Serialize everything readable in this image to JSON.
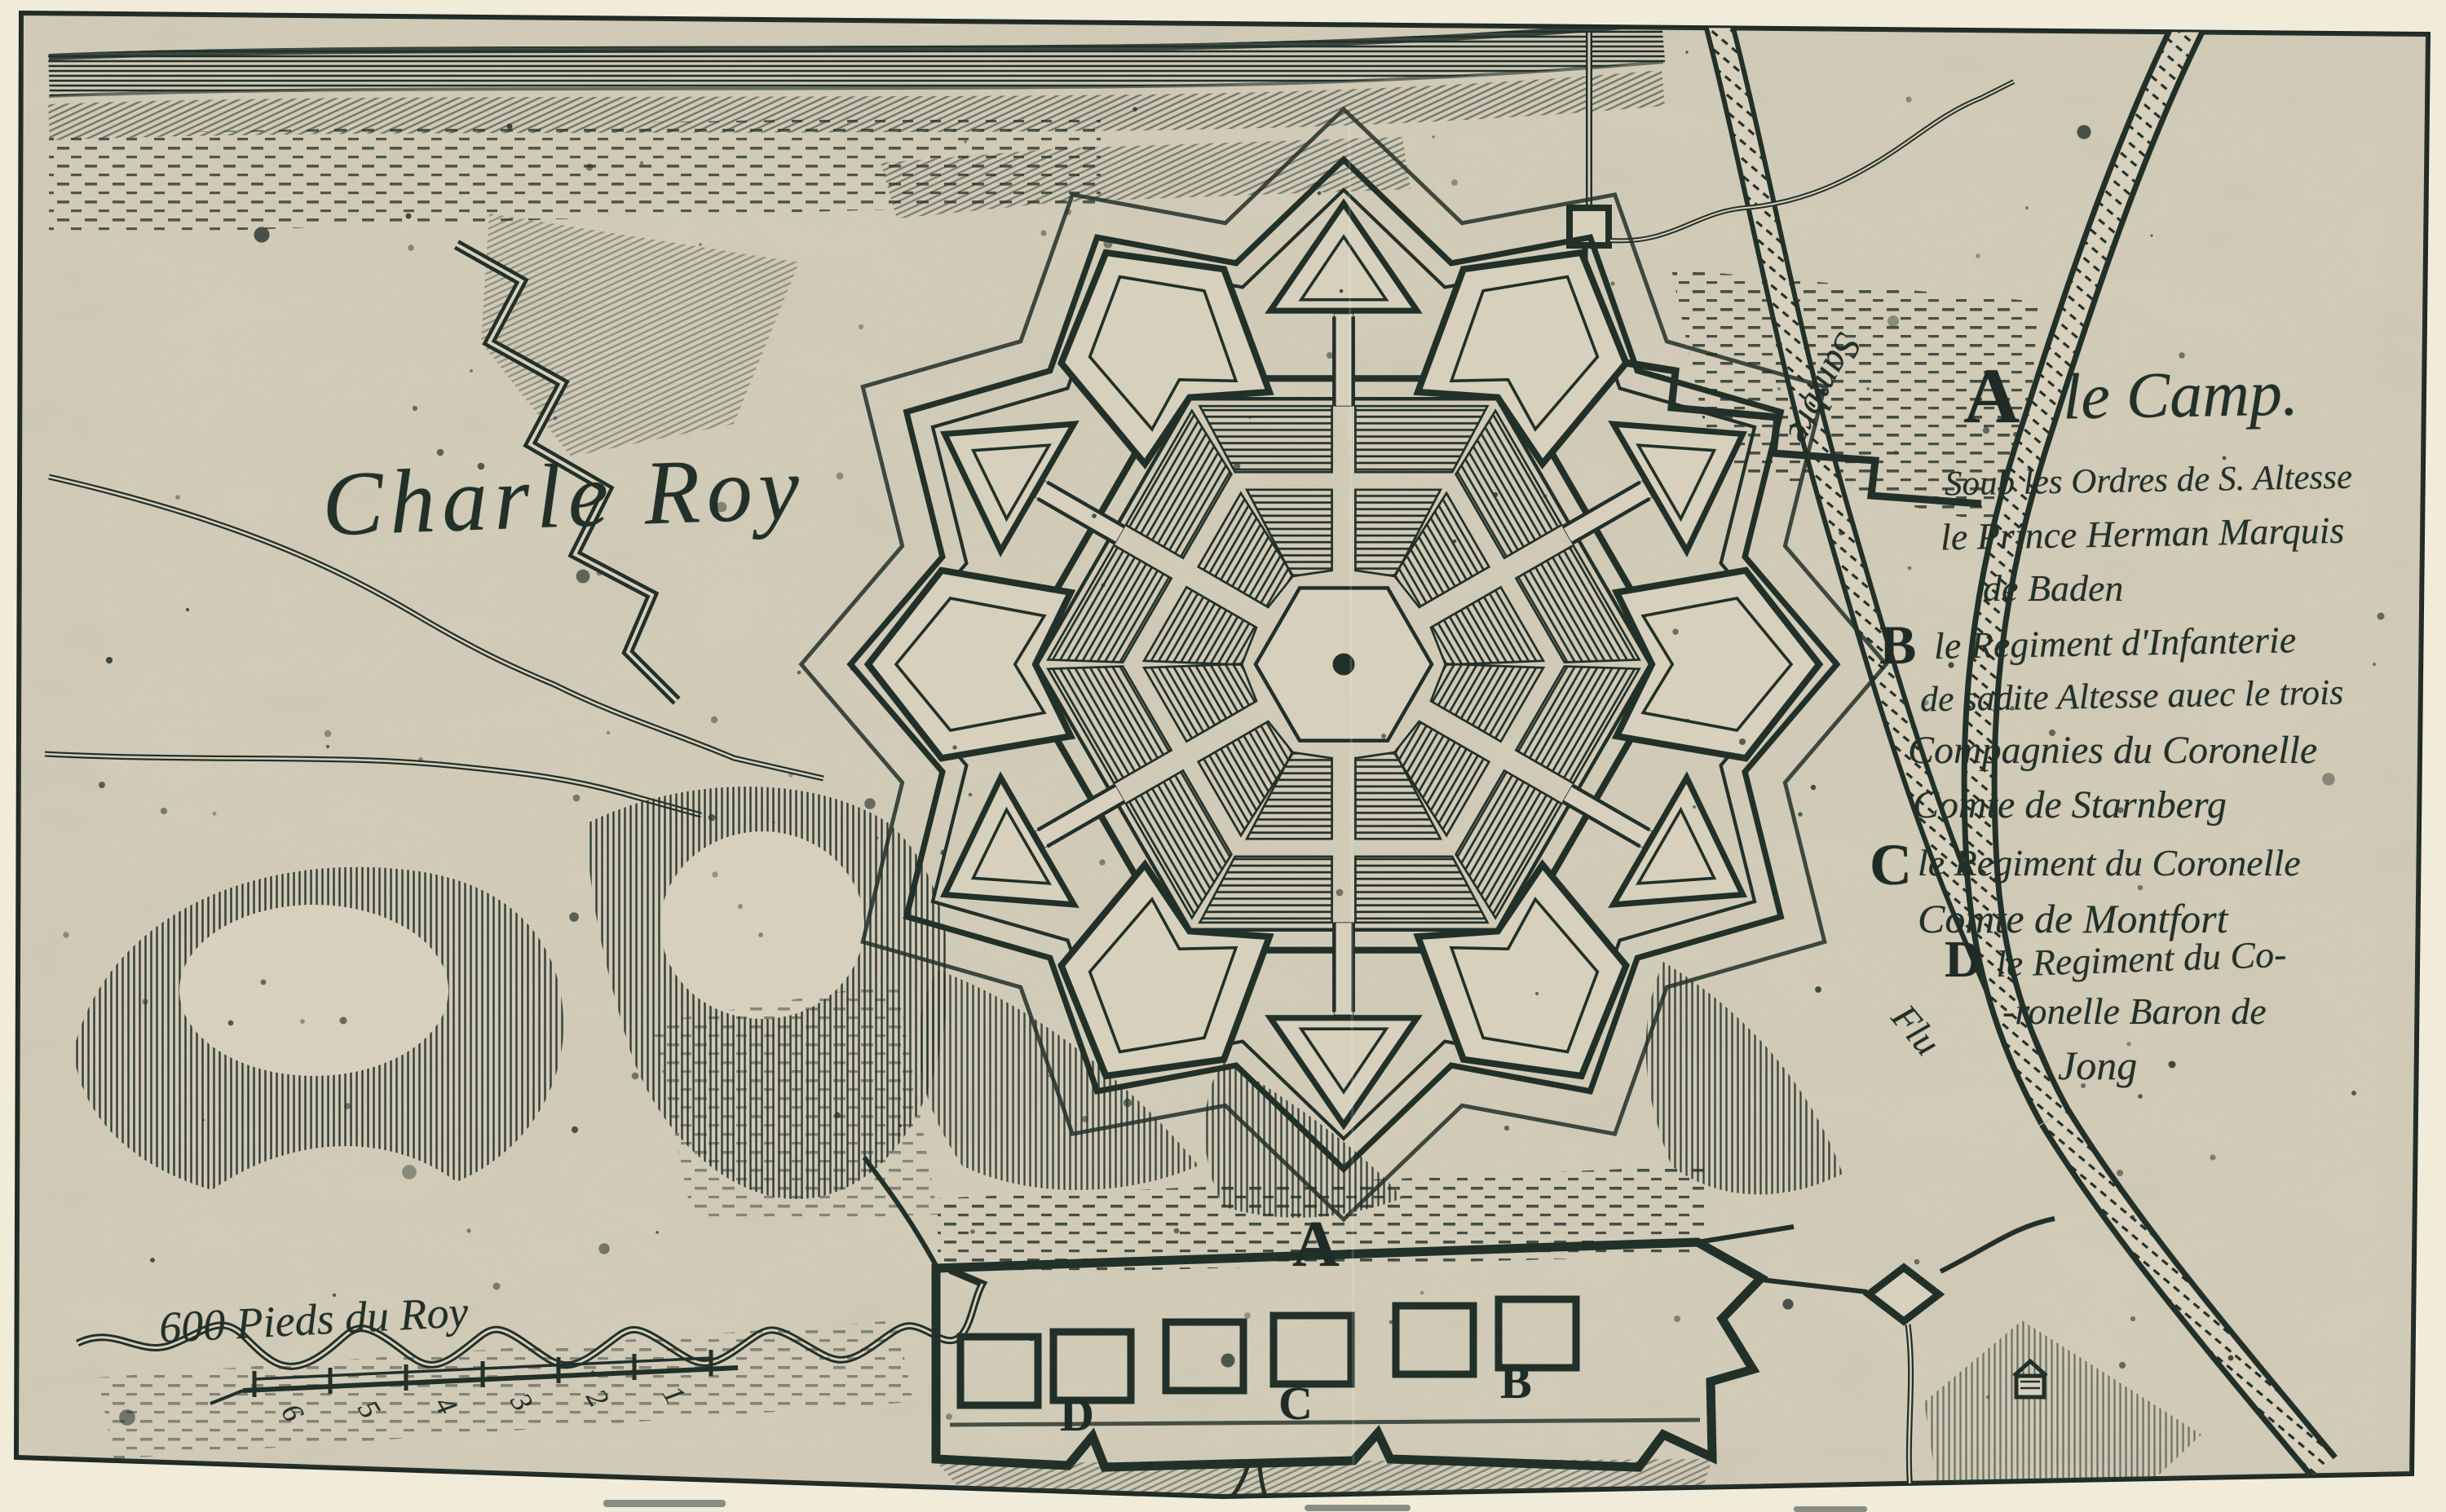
{
  "colors": {
    "ink": "#22302a",
    "paper": "#d7d0bc",
    "margin": "#f1ebd9"
  },
  "place_label": {
    "text": "Charle Roy"
  },
  "river_labels": {
    "sambre": "Sambre",
    "flu": "Flu"
  },
  "scale": {
    "label": "600 Pieds du Roy",
    "numbers": [
      "6",
      "5",
      "4",
      "3",
      "2",
      "1"
    ]
  },
  "camp": {
    "marker": "A",
    "letters": {
      "d": "D",
      "c": "C",
      "b": "B"
    }
  },
  "legend": {
    "entries": [
      {
        "key": "A",
        "title": "le Camp.",
        "lines": [
          "Soub les Ordres de S. Altesse",
          "le Prince Herman Marquis",
          "de Baden"
        ]
      },
      {
        "key": "B",
        "title": "",
        "lines": [
          "le Regiment d'Infanterie",
          "de sadite Altesse auec le trois",
          "Compagnies du Coronelle",
          "Comte de Starnberg"
        ]
      },
      {
        "key": "C",
        "title": "",
        "lines": [
          "le Regiment du Coronelle",
          "Comte de Montfort"
        ]
      },
      {
        "key": "D",
        "title": "",
        "lines": [
          "le Regiment du Co-",
          "-ronelle Baron de",
          "Jong"
        ]
      }
    ]
  }
}
